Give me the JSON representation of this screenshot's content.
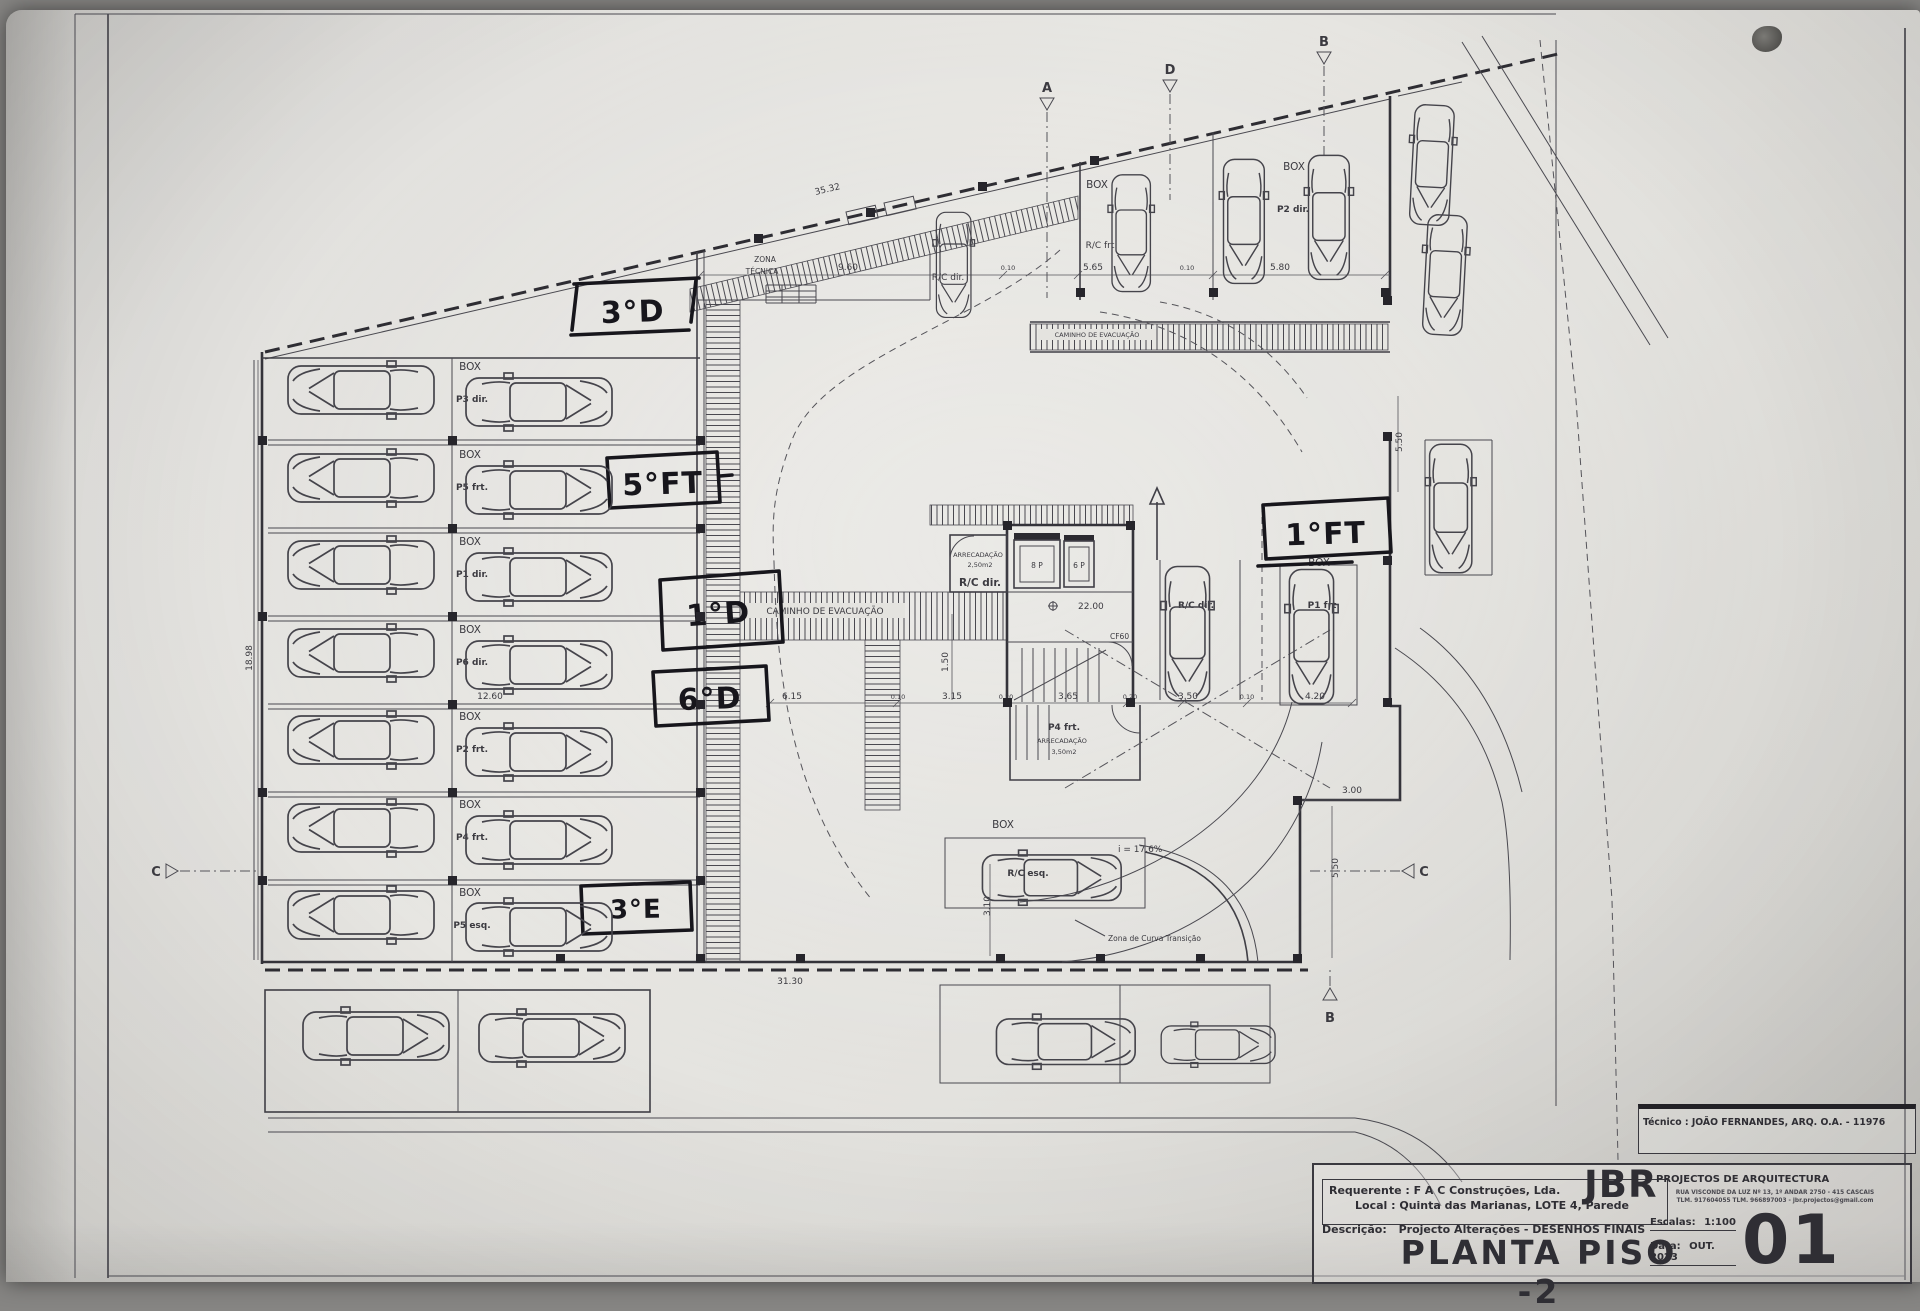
{
  "sheet": {
    "technician_label": "Técnico : JOÃO FERNANDES, ARQ.  O.A. - 11976",
    "firm": {
      "initials": "JBR",
      "name": "PROJECTOS DE ARQUITECTURA",
      "address_line1": "RUA VISCONDE DA LUZ Nº 13, 1º ANDAR  2750 - 415 CASCAIS",
      "address_line2": "TLM. 917604055  TLM. 966897003 - jbr.projectos@gmail.com"
    },
    "requerente_label": "Requerente : F A C Construções, Lda.",
    "local_label": "Local : Quinta das Marianas, LOTE 4, Parede",
    "descricao_label": "Descrição:",
    "descricao_value": "Projecto Alterações - DESENHOS FINAIS",
    "drawing_title": "PLANTA PISO -2",
    "escala_label": "Escalas:",
    "escala_value": "1:100",
    "data_label": "Data:",
    "data_value": "OUT. 2023",
    "sheet_number": "01"
  },
  "handwritten": [
    "3°D",
    "5°FT",
    "1°D",
    "6°D",
    "3°E",
    "1°FT"
  ],
  "plan": {
    "zona_tecnica_line1": "ZONA",
    "zona_tecnica_line2": "TÉCNICA",
    "caminho_evacuacao": "CAMINHO DE EVACUAÇÃO",
    "slope": "i = 17.6%",
    "curve_note": "Zona de Curva Transição",
    "level_mark": "22.00",
    "door_code": "CF60",
    "elevators": [
      "8 P",
      "6 P"
    ],
    "storage_core": {
      "line1": "ARRECADAÇÃO",
      "line2": "2,50m2",
      "unit": "R/C dir."
    },
    "storage_stair": {
      "unit": "P4 frt.",
      "line1": "ARRECADAÇÃO",
      "line2": "3,50m2"
    },
    "left_stalls": [
      {
        "box": "BOX",
        "unit": "P3 dir."
      },
      {
        "box": "BOX",
        "unit": "P5 frt."
      },
      {
        "box": "BOX",
        "unit": "P1 dir."
      },
      {
        "box": "BOX",
        "unit": "P6 dir."
      },
      {
        "box": "BOX",
        "unit": "P2 frt."
      },
      {
        "box": "BOX",
        "unit": "P4 frt."
      },
      {
        "box": "BOX",
        "unit": "P5 esq."
      }
    ],
    "top_stalls": [
      {
        "box": "BOX",
        "unit": "R/C frt"
      },
      {
        "box": "BOX",
        "unit": "P2 dir."
      }
    ],
    "right_stall": {
      "box": "BOX",
      "unit": "P1 frt"
    },
    "center_stall_unit": "R/C dir.",
    "bottom_stall": {
      "box": "BOX",
      "unit": "R/C esq."
    },
    "section_markers": [
      "A",
      "D",
      "B",
      "C",
      "C",
      "B"
    ],
    "dimensions": [
      "35.32",
      "9.60",
      "0.10",
      "5.65",
      "0.10",
      "5.80",
      "12.60",
      "6.15",
      "0.10",
      "3.15",
      "0.20",
      "3.65",
      "0.20",
      "3.50",
      "0.10",
      "4.20",
      "3.00",
      "5.50",
      "31.30",
      "1.50",
      "3.10",
      "18.98",
      "5.50"
    ]
  }
}
